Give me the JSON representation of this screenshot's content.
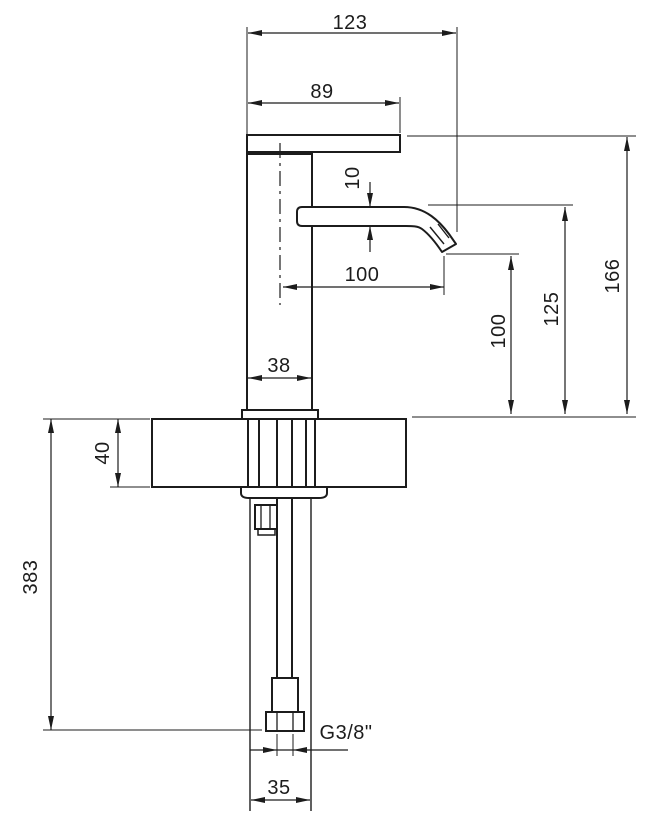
{
  "figure": {
    "kind": "technical dimension drawing",
    "background": "#ffffff",
    "line_color": "#1c1c1c"
  },
  "dims": {
    "overall_width": "123",
    "handle_length": "89",
    "spout_height": "10",
    "spout_reach": "100",
    "tip_clearance": "100",
    "outlet_height": "125",
    "total_height": "166",
    "body_width": "38",
    "deck_thickness": "40",
    "supply_length": "383",
    "thread": "G3/8\"",
    "lower_width": "35"
  }
}
